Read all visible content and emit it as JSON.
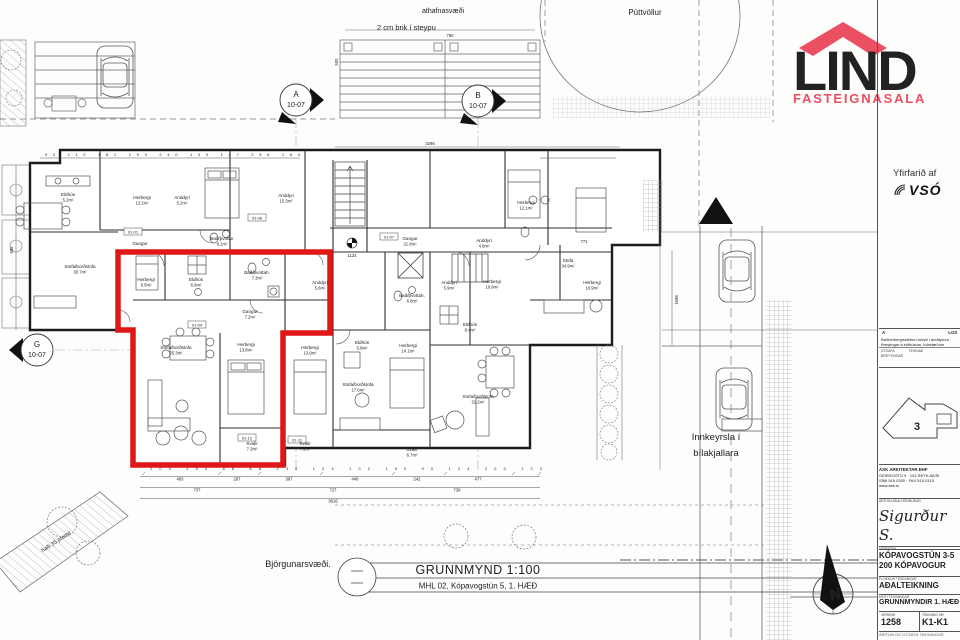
{
  "logo": {
    "name": "LIND",
    "sub": "FASTEIGNASALA",
    "red": "#ea4f62",
    "gray": "#57585a"
  },
  "review": {
    "label": "Yfirfarið af",
    "firm": "VSÓ"
  },
  "site": {
    "puttvollur": "Púttvöllur",
    "athafnasvaedi": "athafnasvæði",
    "brik": "2 cm brik í steypu",
    "innkeyrsla1": "Innkeyrsla í",
    "innkeyrsla2": "bílakjallara",
    "bjorgunarsvaedi": "Björgunarsvæði.",
    "halli": "halli 35 promil"
  },
  "caption": {
    "title": "GRUNNMYND 1:100",
    "subtitle": "MHL 02, Kópavogstún 5, 1. HÆÐ"
  },
  "markers": {
    "a": "A",
    "b": "B",
    "g": "G",
    "sheet": "10-07",
    "north": "N",
    "level": "1124"
  },
  "tags": [
    "01-01",
    "01-06",
    "01-04",
    "01-07",
    "01-12",
    "01-11"
  ],
  "rooms": [
    {
      "n": "Eldhús",
      "a": "5.2m²"
    },
    {
      "n": "Herbergi",
      "a": "13.2m²"
    },
    {
      "n": "Anddyri",
      "a": "5.2m²"
    },
    {
      "n": "Anddyri",
      "a": "15.3m²"
    },
    {
      "n": "Bað/þvottur",
      "a": "9.1m²"
    },
    {
      "n": "Gangur",
      "a": ""
    },
    {
      "n": "Stofa/borðstofa",
      "a": "30.7m²"
    },
    {
      "n": "Herbergi",
      "a": "8.5m²"
    },
    {
      "n": "Eldhús",
      "a": "6.9m²"
    },
    {
      "n": "Bað/þvottah.",
      "a": "7.3m²"
    },
    {
      "n": "Anddyri",
      "a": "5.6m²"
    },
    {
      "n": "Gangur",
      "a": "7.2m²"
    },
    {
      "n": "Stofa/borðstofa",
      "a": "25.3m²"
    },
    {
      "n": "Herbergi",
      "a": "13.8m²"
    },
    {
      "n": "Herbergi",
      "a": "13.9m²"
    },
    {
      "n": "Svalir",
      "a": "7.3m²"
    },
    {
      "n": "Svalir",
      "a": "7.3m²"
    },
    {
      "n": "Gangur",
      "a": "21.8m²"
    },
    {
      "n": "Anddyri",
      "a": "4.8m²"
    },
    {
      "n": "Bað/þvottah.",
      "a": "6.8m²"
    },
    {
      "n": "Anddyri",
      "a": "5.9m²"
    },
    {
      "n": "Herbergi",
      "a": "10.9m²"
    },
    {
      "n": "Eldhús",
      "a": "8.4m²"
    },
    {
      "n": "Eldhús",
      "a": "5.8m²"
    },
    {
      "n": "Herbergi",
      "a": "14.1m²"
    },
    {
      "n": "Stofa/borðstofa",
      "a": "17.6m²"
    },
    {
      "n": "Stofa/borðstofa",
      "a": "21.2m²"
    },
    {
      "n": "Svalir",
      "a": "6.7m²"
    },
    {
      "n": "Herbergi",
      "a": "12.1m²"
    },
    {
      "n": "Stofa",
      "a": "34.9m²"
    },
    {
      "n": "Herbergi",
      "a": "10.9m²"
    }
  ],
  "dims": {
    "top_row": "92 110 181 150 240 130 127 256 164",
    "mid_row": "104 150 86 66 230 124 102 150 90 124 200 123",
    "b1": [
      "493",
      "287",
      "387",
      "440",
      "242",
      "477"
    ],
    "b2": [
      "737",
      "727",
      "739"
    ],
    "total": "3616",
    "v1": "585",
    "v2": "1698",
    "v3": "500",
    "v4": "760",
    "v5": "3296",
    "extra": "771"
  },
  "titleblock": {
    "rev_a": "A",
    "rev_initials": "LG3",
    "rev_line1": "Baðherbergisklefum breytt í anddyrum",
    "rev_line2": "Breytingar á eldhúsum, bílastæðum",
    "rev_col1": "ÚTGÁFA",
    "rev_col2": "TEIKNAÐ",
    "rev_label": "BREYTINGAR",
    "keyplan_no": "3",
    "firm_name": "ASK ARKITEKTAR EHF",
    "firm_addr": "GEIRSGÖTU 9 · 101 REYKJAVÍK",
    "firm_tel": "SÍMI 515 0300 · FAX 515 0315",
    "firm_web": "www.ask.is",
    "sign_label": "ÁRITUN AÐALHÖNNUÐAR",
    "signature": "Sigurður S.",
    "project_label": "VERKEFNI",
    "project1": "KÓPAVOGSTÚN 3-5",
    "project2": "200 KÓPAVOGUR",
    "type_label": "FLOKKUR TEIKNINGAR",
    "type": "AÐALTEIKNING",
    "name_label": "HEITI TEIKNINGAR",
    "name": "GRUNNMYNDIR 1. HÆÐ",
    "no_label": "VERKNR.",
    "no": "1258",
    "sheet_label": "TEIKNING NR.",
    "sheet": "K1-K1",
    "footnote": "ÁRITUN OG ÚTGÁFA TEIKNINGAR"
  }
}
